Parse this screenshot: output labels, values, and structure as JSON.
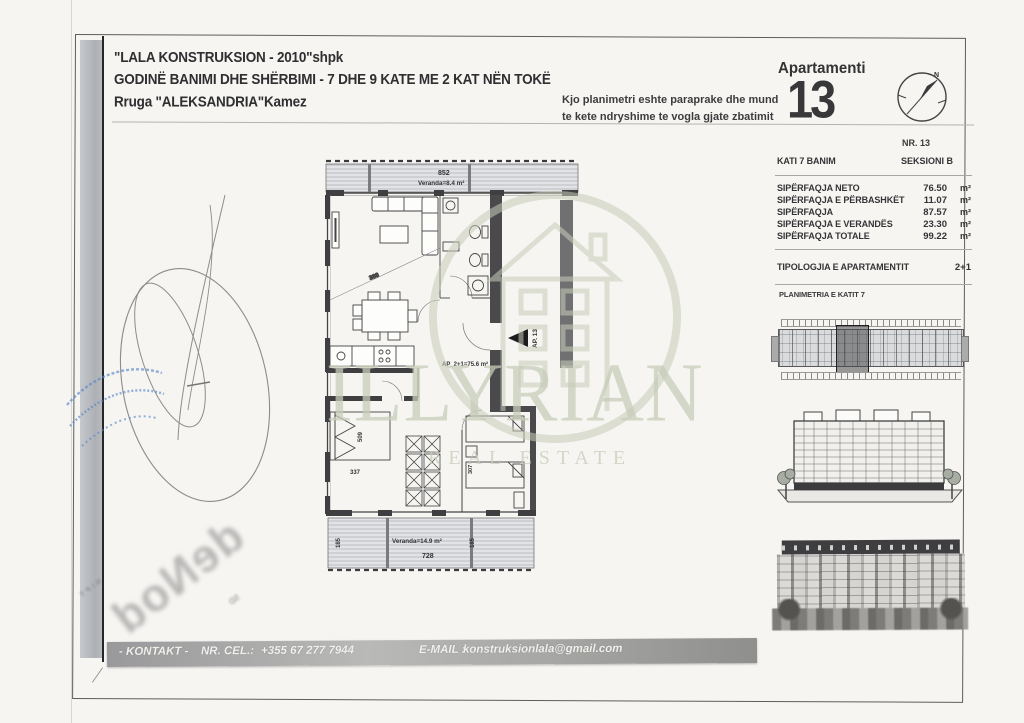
{
  "header": {
    "company": "\"LALA KONSTRUKSION - 2010\"shpk",
    "building": "GODINË BANIMI DHE SHËRBIMI - 7 DHE 9 KATE ME 2 KAT NËN TOKË",
    "address": "Rruga \"ALEKSANDRIA\"Kamez"
  },
  "notice": {
    "line1": "Kjo planimetri eshte paraprake dhe mund",
    "line2": "te kete ndryshime te vogla gjate zbatimit"
  },
  "apartment": {
    "label": "Apartamenti",
    "number": "13",
    "nr": "NR. 13"
  },
  "compass": {
    "north": "N"
  },
  "details": {
    "floor_label": "KATI 7 BANIM",
    "section_label": "SEKSIONI B",
    "rows": [
      {
        "label": "SIPËRFAQJA NETO",
        "value": "76.50",
        "unit": "m²"
      },
      {
        "label": "SIPËRFAQJA E PËRBASHKËT",
        "value": "11.07",
        "unit": "m²"
      },
      {
        "label": "SIPËRFAQJA",
        "value": "87.57",
        "unit": "m²"
      },
      {
        "label": "SIPËRFAQJA E VERANDËS",
        "value": "23.30",
        "unit": "m²"
      },
      {
        "label": "SIPËRFAQJA TOTALE",
        "value": "99.22",
        "unit": "m²"
      }
    ],
    "typology_label": "TIPOLOGJIA E APARTAMENTIT",
    "typology_value": "2+1"
  },
  "plan_section": {
    "title": "PLANIMETRIA E KATIT 7"
  },
  "floor_plan": {
    "veranda_top_label": "Veranda=8.4 m²",
    "veranda_top_dim": "852",
    "veranda_bottom_label": "Veranda=14.9 m²",
    "veranda_bottom_dim": "728",
    "apartment_area": "AP_2+1=75.6 m²",
    "entrance_marker": "AP. 13",
    "dims": {
      "living_diag": "388",
      "bed_width": "337",
      "bed_length": "509",
      "veranda_side": "185",
      "kids_room": "307"
    }
  },
  "watermark": {
    "name": "ILLYRIAN",
    "subtitle": "REAL ESTATE"
  },
  "stamp": {
    "mirror_text": "deNod",
    "fragment_left": "NIPT",
    "fragment_right": "SD"
  },
  "footer": {
    "kontakt": "- KONTAKT -",
    "cel_label": "NR. CEL.:",
    "phone": "+355 67 277 7944",
    "email_label": "E-MAIL :",
    "email": "konstruksionlala@gmail.com"
  }
}
